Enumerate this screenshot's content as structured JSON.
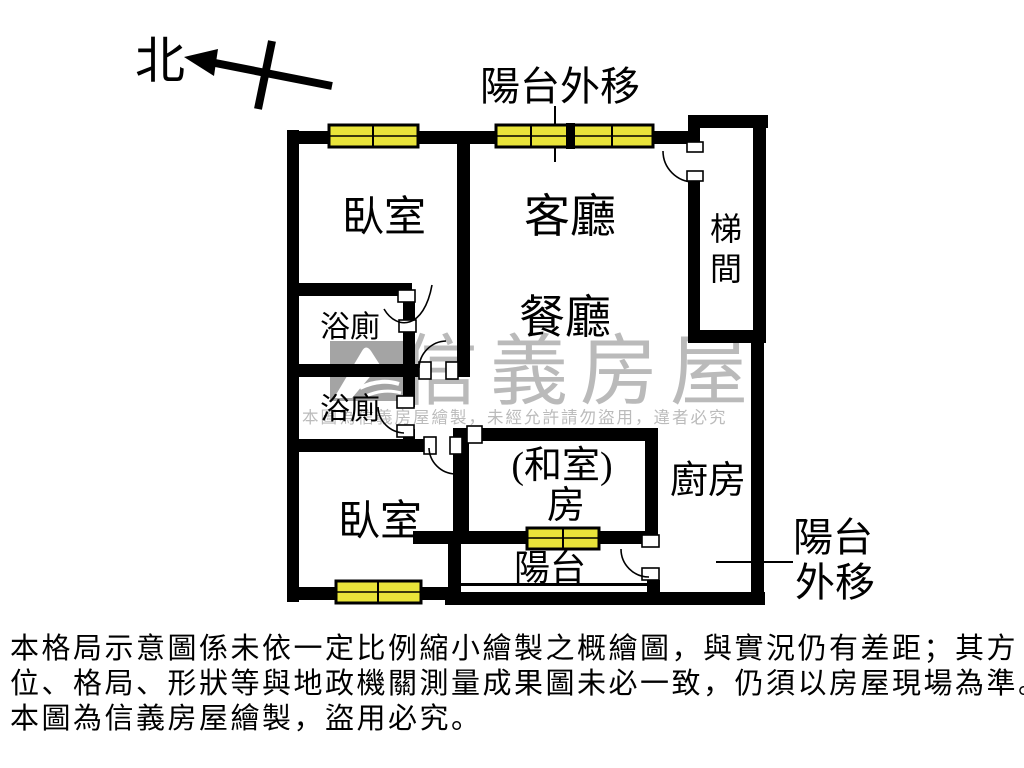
{
  "compass": {
    "north_label": "北"
  },
  "annotations": {
    "balcony_out_top": "陽台外移",
    "balcony_out_right_line1": "陽台",
    "balcony_out_right_line2": "外移"
  },
  "rooms": {
    "bedroom_top": "臥室",
    "living_room": "客廳",
    "dining_room": "餐廳",
    "stairwell_char1": "梯",
    "stairwell_char2": "間",
    "bathroom_top": "浴廁",
    "bathroom_bottom": "浴廁",
    "bedroom_bottom": "臥室",
    "tatami_line1": "(和室)",
    "tatami_line2": "房",
    "kitchen": "廚房",
    "balcony": "陽台"
  },
  "watermark": {
    "brand": "信義房屋",
    "notice": "本圖為信義房屋繪製，未經允許請勿盜用，違者必究"
  },
  "disclaimer": {
    "line1": "本格局示意圖係未依一定比例縮小繪製之概繪圖，與實況仍有差距；其方",
    "line2": "位、格局、形狀等與地政機關測量成果圖未必一致，仍須以房屋現場為準。",
    "line3": "本圖為信義房屋繪製，盜用必究。"
  },
  "colors": {
    "wall": "#000000",
    "window_fill": "#e9e43a",
    "watermark_gray": "#a6a6a6"
  }
}
